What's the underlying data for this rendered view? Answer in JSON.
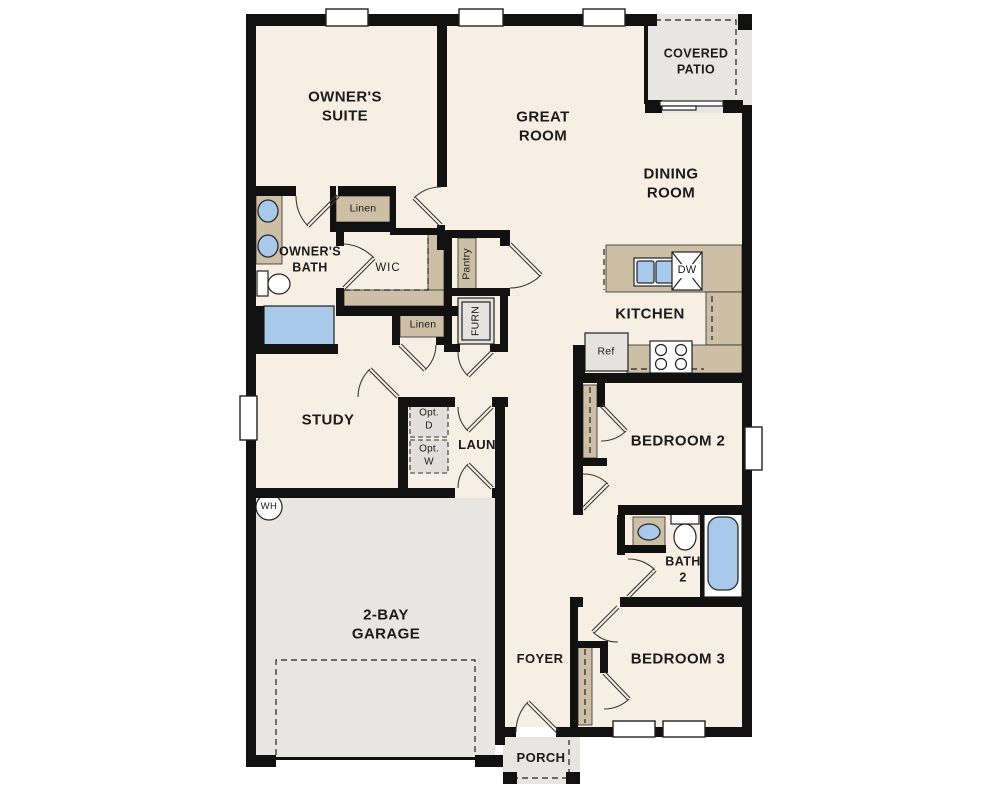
{
  "plan": {
    "title": "Single-story home floor plan",
    "rooms": {
      "owners_suite": "OWNER'S\nSUITE",
      "great_room": "GREAT\nROOM",
      "dining_room": "DINING\nROOM",
      "kitchen": "KITCHEN",
      "covered_patio": "COVERED\nPATIO",
      "owners_bath": "OWNER'S\nBATH",
      "wic": "WIC",
      "study": "STUDY",
      "laundry": "LAUN",
      "bedroom2": "BEDROOM 2",
      "bath2": "BATH\n2",
      "bedroom3": "BEDROOM 3",
      "foyer": "FOYER",
      "porch": "PORCH",
      "garage": "2-BAY\nGARAGE"
    },
    "fixtures": {
      "linen1": "Linen",
      "linen2": "Linen",
      "pantry": "Pantry",
      "furnace": "FURN",
      "opt_dryer": "Opt.\nD",
      "opt_washer": "Opt.\nW",
      "water_heater": "WH",
      "refrigerator": "Ref",
      "dishwasher": "DW"
    },
    "colors": {
      "floor": "#f7efe3",
      "wall": "#111111",
      "casework": "#cdbfa6",
      "exterior_floor": "#e7e6e3",
      "water_fixture": "#a9c9ea",
      "appliance": "#e4e3e0"
    }
  }
}
